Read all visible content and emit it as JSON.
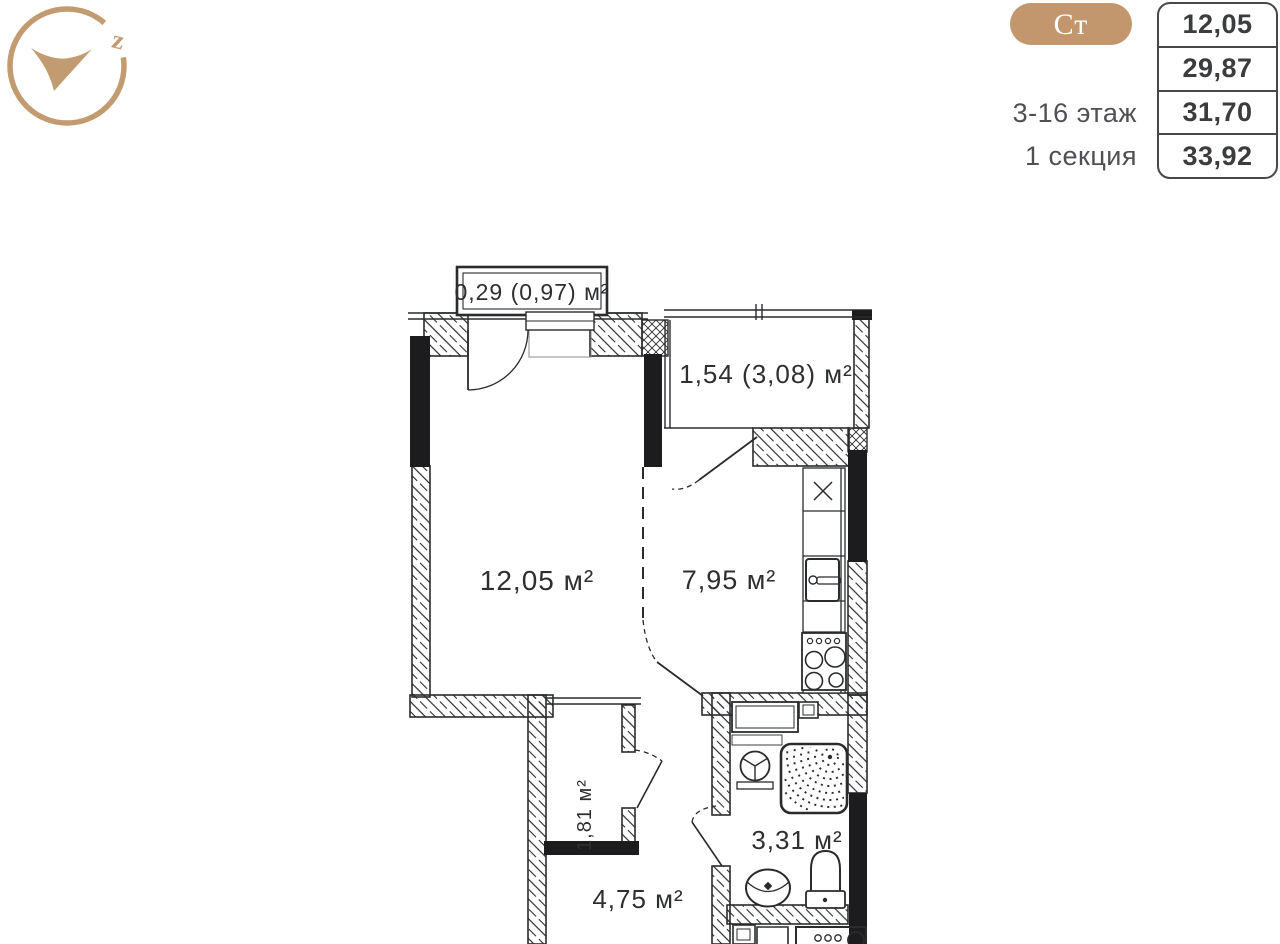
{
  "header": {
    "type_badge": "Ст",
    "floor_label": "3-16 этаж",
    "section_label": "1 секция",
    "area_rows": [
      "12,05",
      "29,87",
      "31,70",
      "33,92"
    ]
  },
  "logo": {
    "letter": "z",
    "icon": "compass-arrow-logo"
  },
  "plan": {
    "rooms": {
      "balcony_top_label": "0,29 (0,97) м²",
      "loggia_label": "1,54 (3,08) м²",
      "living_label": "12,05 м²",
      "kitchen_label": "7,95 м²",
      "wardrobe_label": "1,81 м²",
      "bathroom_label": "3,31 м²",
      "hallway_label": "4,75 м²"
    },
    "fixtures": [
      "kitchen-sink",
      "stove",
      "vent-cabinet",
      "washer",
      "shower",
      "washbasin",
      "toilet",
      "washing-machine"
    ]
  },
  "colors": {
    "accent": "#c3976d",
    "plan_line": "#2a2b2d",
    "value_text": "#3b3c3e",
    "muted_text": "#4f5054"
  }
}
